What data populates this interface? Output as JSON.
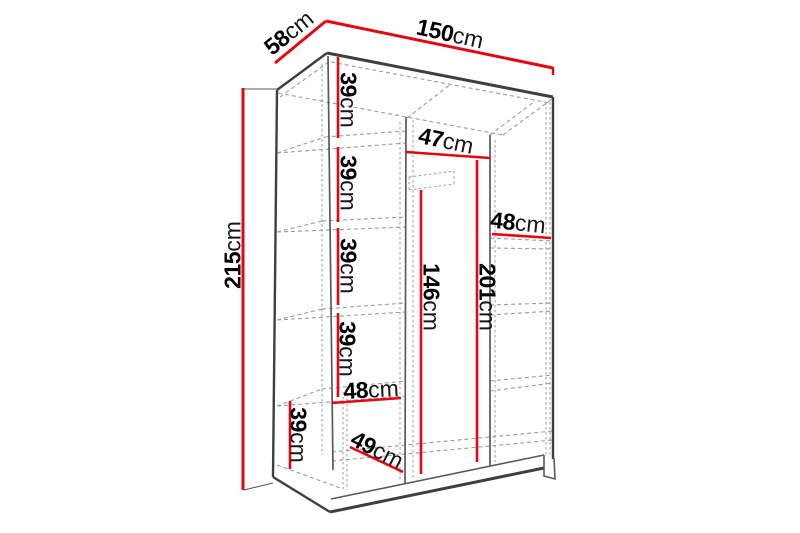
{
  "diagram": {
    "type": "furniture-dimension-wireframe",
    "subject": "three-section wardrobe with shelves and hanging rail",
    "unit": "cm",
    "colors": {
      "dimension_accent": "#e30613",
      "visible_edge": "#3f3f3f",
      "hidden_edge": "#9b9b9b",
      "text": "#000000",
      "background": "#ffffff"
    },
    "dimensions": {
      "depth": {
        "num": "58",
        "unit": "cm"
      },
      "width": {
        "num": "150",
        "unit": "cm"
      },
      "height": {
        "num": "215",
        "unit": "cm"
      },
      "shelf_gap_1": {
        "num": "39",
        "unit": "cm"
      },
      "shelf_gap_2": {
        "num": "39",
        "unit": "cm"
      },
      "shelf_gap_3": {
        "num": "39",
        "unit": "cm"
      },
      "shelf_gap_4": {
        "num": "39",
        "unit": "cm"
      },
      "middle_section_width": {
        "num": "47",
        "unit": "cm"
      },
      "right_section_width": {
        "num": "48",
        "unit": "cm"
      },
      "hanging_space_height": {
        "num": "146",
        "unit": "cm"
      },
      "right_section_height": {
        "num": "201",
        "unit": "cm"
      },
      "left_section_width": {
        "num": "48",
        "unit": "cm"
      },
      "bottom_compartment_height": {
        "num": "39",
        "unit": "cm"
      },
      "interior_depth": {
        "num": "49",
        "unit": "cm"
      }
    }
  }
}
